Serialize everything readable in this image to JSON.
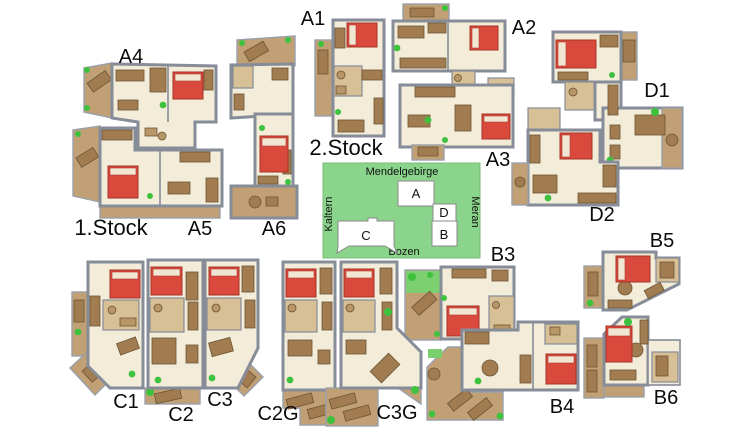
{
  "figure": {
    "type": "apartment-floor-plan-overview",
    "description": "Floor plans of holiday apartments with orientation map"
  },
  "floor_labels": {
    "first_floor": "1.Stock",
    "second_floor": "2.Stock"
  },
  "apartments": {
    "a1": "A1",
    "a2": "A2",
    "a3": "A3",
    "a4": "A4",
    "a5": "A5",
    "a6": "A6",
    "b3": "B3",
    "b4": "B4",
    "b5": "B5",
    "b6": "B6",
    "c1": "C1",
    "c2": "C2",
    "c3": "C3",
    "c2g": "C2G",
    "c3g": "C3G",
    "d1": "D1",
    "d2": "D2"
  },
  "map": {
    "north": "Mendelgebirge",
    "west": "Kaltern",
    "east": "Meran",
    "south": "Bozen",
    "buildings": {
      "a": "A",
      "b": "B",
      "c": "C",
      "d": "D"
    }
  },
  "colors": {
    "wall": "#868c98",
    "floor": "#f2ecd9",
    "terrace": "#c2a076",
    "furniture": "#a07c50",
    "bed": "#d94a3d",
    "plant": "#3ec23e",
    "map_green": "#8bd48b"
  }
}
